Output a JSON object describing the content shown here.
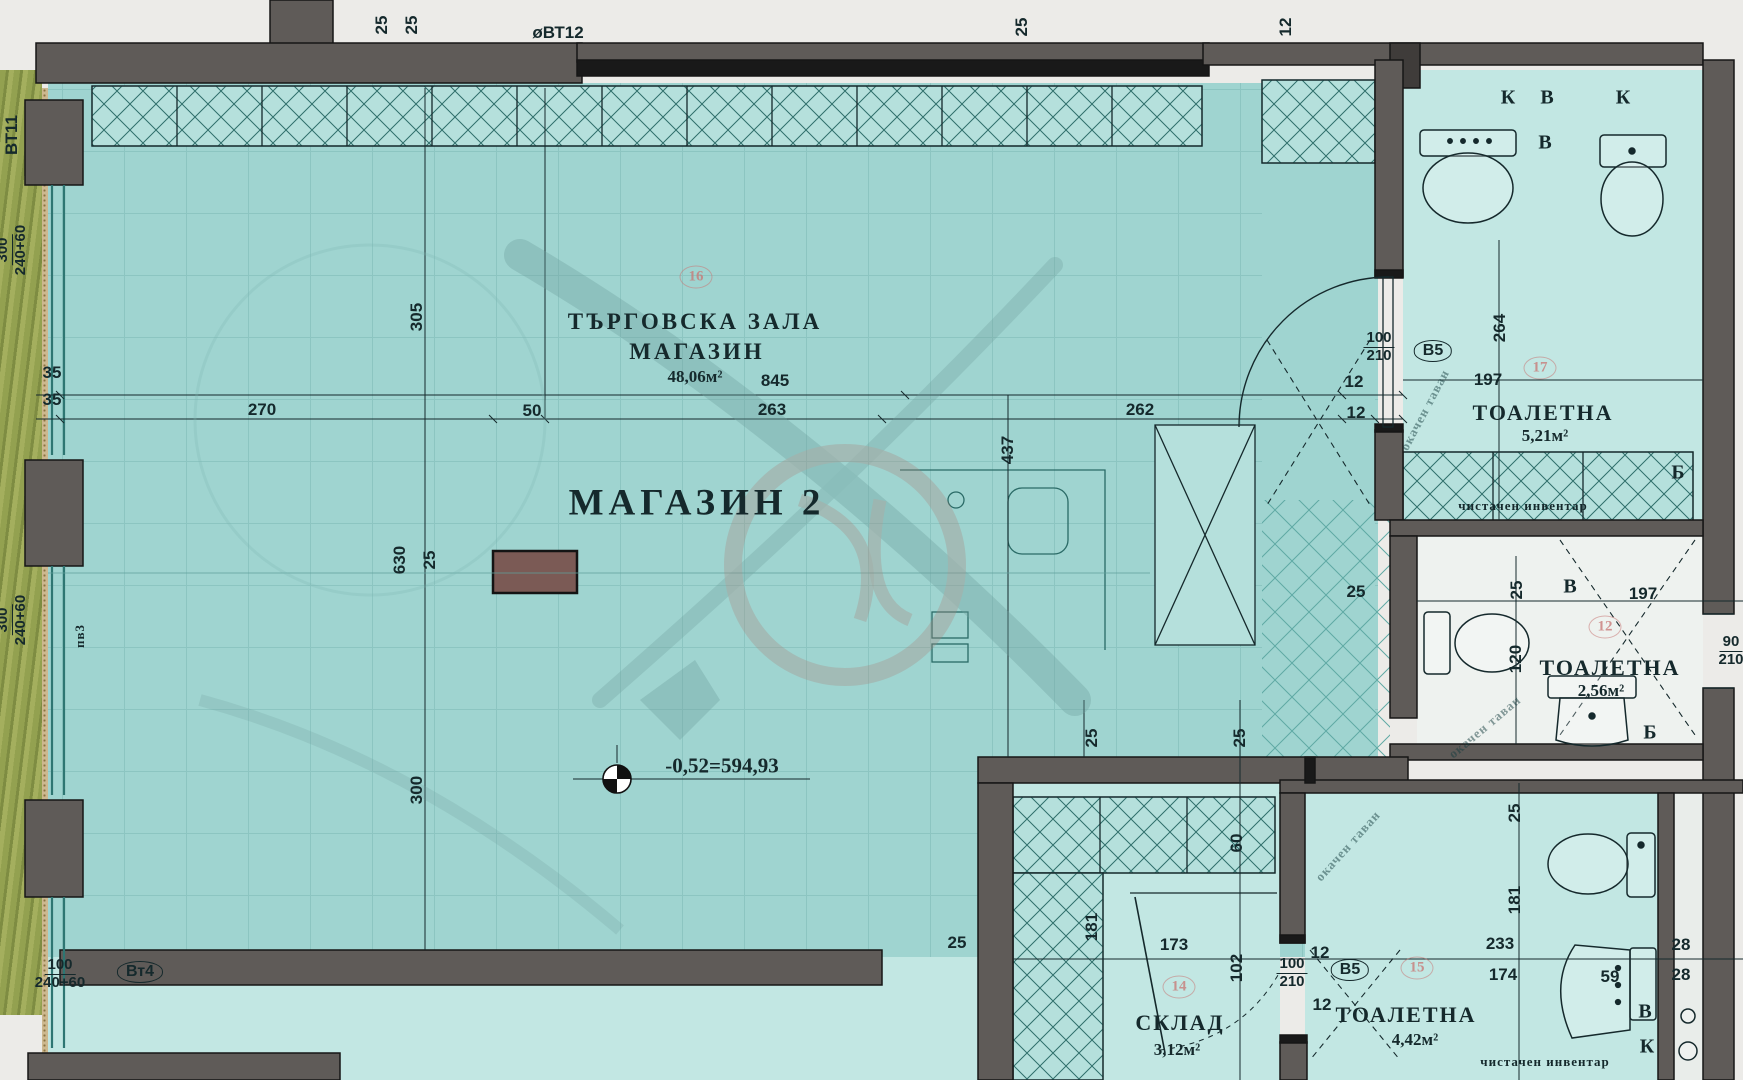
{
  "colors": {
    "paper": "#ecebe8",
    "teal": "#9fd4d0",
    "tealLight": "#c2e7e3",
    "white": "#eef2ef",
    "wall": "#5f5b58",
    "line": "#15292c",
    "hatch": "#2f6f6b",
    "glass": "#2e7672",
    "grass": "#8d9b4d",
    "column": "#7b5a55",
    "wm": "#6f9f9c",
    "wm2": "#a8887f"
  },
  "plan_title": "МАГАЗИН 2",
  "labels": [
    {
      "t": "25",
      "x": 382,
      "y": 25,
      "r": -90,
      "c": "dim"
    },
    {
      "t": "25",
      "x": 412,
      "y": 25,
      "r": -90,
      "c": "dim"
    },
    {
      "t": "øВТ12",
      "x": 558,
      "y": 33,
      "c": "dim"
    },
    {
      "t": "25",
      "x": 1022,
      "y": 27,
      "r": -90,
      "c": "dim"
    },
    {
      "t": "12",
      "x": 1286,
      "y": 27,
      "r": -90,
      "c": "dim"
    },
    {
      "t": "ВТ11",
      "x": 12,
      "y": 135,
      "r": -90,
      "c": "dim"
    },
    {
      "t": "пв3",
      "x": 80,
      "y": 636,
      "r": -90,
      "c": "small"
    },
    {
      "t": "35",
      "x": 52,
      "y": 373,
      "c": "dim"
    },
    {
      "t": "35",
      "x": 52,
      "y": 400,
      "c": "dim"
    },
    {
      "t": "270",
      "x": 262,
      "y": 410,
      "c": "dim"
    },
    {
      "t": "50",
      "x": 532,
      "y": 411,
      "c": "dim"
    },
    {
      "t": "845",
      "x": 775,
      "y": 381,
      "c": "dim"
    },
    {
      "t": "263",
      "x": 772,
      "y": 410,
      "c": "dim"
    },
    {
      "t": "262",
      "x": 1140,
      "y": 410,
      "c": "dim"
    },
    {
      "t": "12",
      "x": 1354,
      "y": 382,
      "c": "dim"
    },
    {
      "t": "12",
      "x": 1356,
      "y": 413,
      "c": "dim"
    },
    {
      "t": "305",
      "x": 417,
      "y": 317,
      "r": -90,
      "c": "dim"
    },
    {
      "t": "630",
      "x": 400,
      "y": 560,
      "r": -90,
      "c": "dim"
    },
    {
      "t": "25",
      "x": 430,
      "y": 560,
      "r": -90,
      "c": "dim"
    },
    {
      "t": "300",
      "x": 417,
      "y": 790,
      "r": -90,
      "c": "dim"
    },
    {
      "t": "437",
      "x": 1008,
      "y": 450,
      "r": -90,
      "c": "dim"
    },
    {
      "t": "ТЪРГОВСКА ЗАЛА",
      "x": 695,
      "y": 322,
      "c": "title"
    },
    {
      "t": "МАГАЗИН",
      "x": 697,
      "y": 352,
      "c": "title"
    },
    {
      "t": "48,06м²",
      "x": 695,
      "y": 377,
      "c": "area"
    },
    {
      "t": "МАГАЗИН 2",
      "x": 697,
      "y": 503,
      "c": "big"
    },
    {
      "t": "-0,52=594,93",
      "x": 722,
      "y": 766,
      "c": "elev"
    },
    {
      "t": "К",
      "x": 1508,
      "y": 98,
      "c": "letter"
    },
    {
      "t": "В",
      "x": 1547,
      "y": 98,
      "c": "letter"
    },
    {
      "t": "К",
      "x": 1623,
      "y": 98,
      "c": "letter"
    },
    {
      "t": "В",
      "x": 1545,
      "y": 143,
      "c": "letter"
    },
    {
      "t": "264",
      "x": 1500,
      "y": 328,
      "r": -90,
      "c": "dim"
    },
    {
      "t": "197",
      "x": 1488,
      "y": 380,
      "c": "dim"
    },
    {
      "t": "ТОАЛЕТНА",
      "x": 1543,
      "y": 413,
      "c": "room"
    },
    {
      "t": "5,21м²",
      "x": 1545,
      "y": 436,
      "c": "area"
    },
    {
      "t": "Б",
      "x": 1678,
      "y": 473,
      "c": "letter"
    },
    {
      "t": "чистачен инвентар",
      "x": 1523,
      "y": 506,
      "c": "small"
    },
    {
      "t": "окачен таван",
      "x": 1425,
      "y": 410,
      "r": -62,
      "c": "diag"
    },
    {
      "t": "25",
      "x": 1356,
      "y": 592,
      "c": "dim"
    },
    {
      "t": "25",
      "x": 1517,
      "y": 590,
      "r": -90,
      "c": "dim"
    },
    {
      "t": "В",
      "x": 1570,
      "y": 587,
      "c": "letter"
    },
    {
      "t": "197",
      "x": 1643,
      "y": 594,
      "c": "dim"
    },
    {
      "t": "120",
      "x": 1516,
      "y": 659,
      "r": -90,
      "c": "dim"
    },
    {
      "t": "ТОАЛЕТНА",
      "x": 1610,
      "y": 668,
      "c": "room"
    },
    {
      "t": "2,56м²",
      "x": 1601,
      "y": 691,
      "c": "area"
    },
    {
      "t": "окачен таван",
      "x": 1485,
      "y": 727,
      "r": -40,
      "c": "diag"
    },
    {
      "t": "Б",
      "x": 1650,
      "y": 733,
      "c": "letter"
    },
    {
      "t": "25",
      "x": 957,
      "y": 943,
      "c": "dim"
    },
    {
      "t": "25",
      "x": 1092,
      "y": 738,
      "r": -90,
      "c": "dim"
    },
    {
      "t": "25",
      "x": 1240,
      "y": 738,
      "r": -90,
      "c": "dim"
    },
    {
      "t": "60",
      "x": 1237,
      "y": 843,
      "r": -90,
      "c": "dim"
    },
    {
      "t": "181",
      "x": 1092,
      "y": 927,
      "r": -90,
      "c": "dim"
    },
    {
      "t": "173",
      "x": 1174,
      "y": 945,
      "c": "dim"
    },
    {
      "t": "102",
      "x": 1237,
      "y": 968,
      "r": -90,
      "c": "dim"
    },
    {
      "t": "12",
      "x": 1320,
      "y": 953,
      "c": "dim"
    },
    {
      "t": "12",
      "x": 1322,
      "y": 1005,
      "c": "dim"
    },
    {
      "t": "окачен таван",
      "x": 1348,
      "y": 846,
      "r": -48,
      "c": "diag"
    },
    {
      "t": "СКЛАД",
      "x": 1180,
      "y": 1023,
      "c": "room"
    },
    {
      "t": "3,12м²",
      "x": 1177,
      "y": 1050,
      "c": "area"
    },
    {
      "t": "ТОАЛЕТНА",
      "x": 1406,
      "y": 1015,
      "c": "room"
    },
    {
      "t": "4,42м²",
      "x": 1415,
      "y": 1040,
      "c": "area"
    },
    {
      "t": "чистачен инвентар",
      "x": 1545,
      "y": 1062,
      "c": "small"
    },
    {
      "t": "233",
      "x": 1500,
      "y": 944,
      "c": "dim"
    },
    {
      "t": "174",
      "x": 1503,
      "y": 975,
      "c": "dim"
    },
    {
      "t": "59",
      "x": 1610,
      "y": 977,
      "c": "dim"
    },
    {
      "t": "28",
      "x": 1681,
      "y": 945,
      "c": "dim"
    },
    {
      "t": "28",
      "x": 1681,
      "y": 975,
      "c": "dim"
    },
    {
      "t": "181",
      "x": 1515,
      "y": 900,
      "r": -90,
      "c": "dim"
    },
    {
      "t": "25",
      "x": 1515,
      "y": 813,
      "r": -90,
      "c": "dim"
    },
    {
      "t": "В",
      "x": 1645,
      "y": 1012,
      "c": "letter"
    },
    {
      "t": "К",
      "x": 1647,
      "y": 1047,
      "c": "letter"
    }
  ],
  "specs": [
    {
      "top": "100",
      "bottom": "210",
      "x": 1379,
      "y": 347
    },
    {
      "top": "90",
      "bottom": "210",
      "x": 1731,
      "y": 651
    },
    {
      "top": "100",
      "bottom": "210",
      "x": 1292,
      "y": 973
    },
    {
      "top": "100",
      "bottom": "240+60",
      "x": 60,
      "y": 974
    },
    {
      "top": "300",
      "bottom": "240+60",
      "x": 12,
      "y": 250,
      "r": -90
    },
    {
      "top": "300",
      "bottom": "240+60",
      "x": 12,
      "y": 620,
      "r": -90
    }
  ],
  "etags": [
    {
      "t": "В5",
      "x": 1433,
      "y": 351
    },
    {
      "t": "В5",
      "x": 1350,
      "y": 970
    },
    {
      "t": "Вт4",
      "x": 140,
      "y": 972
    }
  ],
  "bubbles": [
    {
      "t": "16",
      "x": 696,
      "y": 277
    },
    {
      "t": "17",
      "x": 1540,
      "y": 368
    },
    {
      "t": "12",
      "x": 1605,
      "y": 627
    },
    {
      "t": "14",
      "x": 1179,
      "y": 987
    },
    {
      "t": "15",
      "x": 1417,
      "y": 968
    }
  ]
}
